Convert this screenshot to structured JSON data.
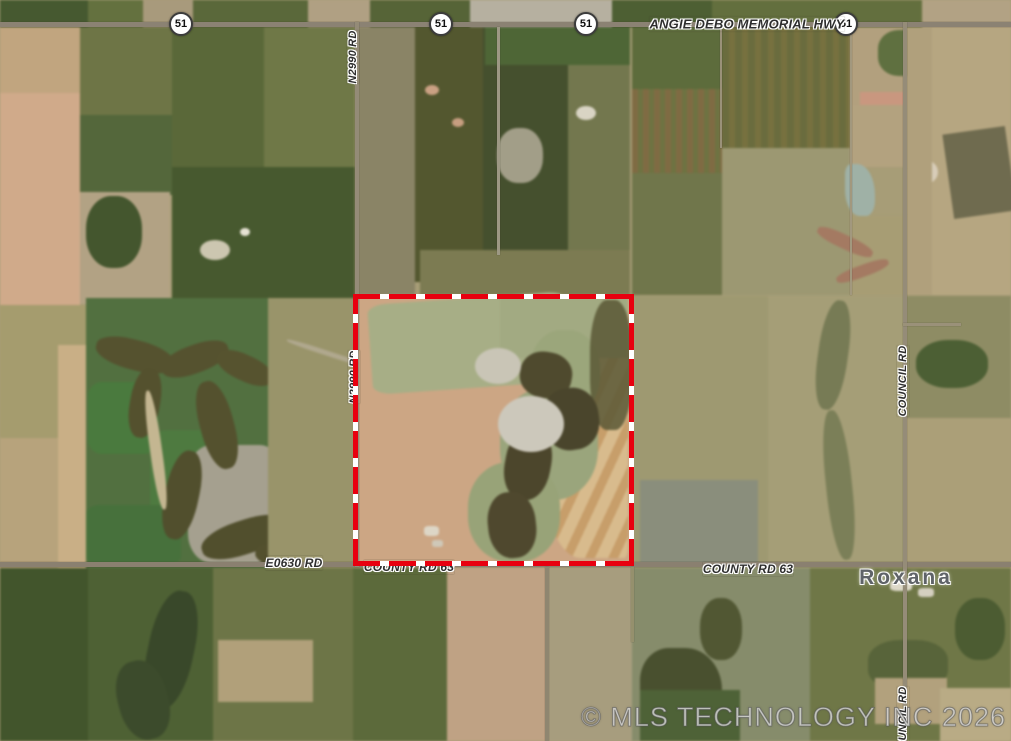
{
  "watermark": {
    "text": "© MLS TECHNOLOGY INC 2026"
  },
  "boundary": {
    "x": 353,
    "y": 294,
    "w": 281,
    "h": 272,
    "t": 5,
    "color": "#e8000f",
    "dash": "#ffffff",
    "seg": 27,
    "gap": 9
  },
  "map": {
    "base_color": "#a79d77",
    "road_color": "#8b8273",
    "shield_label": "51",
    "shields": [
      {
        "x": 181,
        "y": 24
      },
      {
        "x": 441,
        "y": 24
      },
      {
        "x": 586,
        "y": 24
      },
      {
        "x": 846,
        "y": 24
      }
    ],
    "labels": [
      {
        "text": "ANGIE DEBO MEMORIAL HWY",
        "x": 747,
        "y": 24,
        "rot": 0,
        "fs": 13,
        "cls": "road"
      },
      {
        "text": "N2990 RD",
        "x": 353,
        "y": 57,
        "rot": -90,
        "fs": 11,
        "cls": "road"
      },
      {
        "text": "N2990 RD",
        "x": 354,
        "y": 377,
        "rot": -90,
        "fs": 11,
        "cls": "road"
      },
      {
        "text": "COUNCIL RD",
        "x": 903,
        "y": 381,
        "rot": -90,
        "fs": 11,
        "cls": "road"
      },
      {
        "text": "COUNCIL RD",
        "x": 903,
        "y": 722,
        "rot": -90,
        "fs": 11,
        "cls": "road"
      },
      {
        "text": "E0630 RD",
        "x": 294,
        "y": 563,
        "rot": 0,
        "fs": 12,
        "cls": "road"
      },
      {
        "text": "COUNTY RD 63",
        "x": 409,
        "y": 567,
        "rot": 0,
        "fs": 12,
        "cls": "road"
      },
      {
        "text": "COUNTY RD 63",
        "x": 748,
        "y": 569,
        "rot": 0,
        "fs": 12,
        "cls": "road"
      },
      {
        "text": "Roxana",
        "x": 906,
        "y": 578,
        "rot": 0,
        "fs": 21,
        "cls": "place"
      }
    ],
    "roads": [
      {
        "o": "h",
        "x": 0,
        "y": 22,
        "len": 1011,
        "t": 5,
        "c": "#8b8273"
      },
      {
        "o": "h",
        "x": 0,
        "y": 562,
        "len": 1011,
        "t": 5,
        "c": "#8a8070"
      },
      {
        "o": "v",
        "x": 355,
        "y": 22,
        "len": 545,
        "t": 4,
        "c": "#948b77"
      },
      {
        "o": "v",
        "x": 903,
        "y": 22,
        "len": 719,
        "t": 4,
        "c": "#958c78"
      },
      {
        "o": "v",
        "x": 545,
        "y": 567,
        "len": 174,
        "t": 4,
        "c": "#8f8670"
      },
      {
        "o": "v",
        "x": 631,
        "y": 567,
        "len": 75,
        "t": 3,
        "c": "#95906d"
      },
      {
        "o": "v",
        "x": 720,
        "y": 22,
        "len": 126,
        "t": 2,
        "c": "#9a9179"
      },
      {
        "o": "v",
        "x": 850,
        "y": 22,
        "len": 273,
        "t": 2,
        "c": "#a2987e"
      },
      {
        "o": "h",
        "x": 903,
        "y": 323,
        "len": 58,
        "t": 3,
        "c": "#9a9179"
      },
      {
        "o": "v",
        "x": 497,
        "y": 27,
        "len": 228,
        "t": 3,
        "c": "#9d9884"
      }
    ],
    "patches": [
      {
        "x": 0,
        "y": 0,
        "w": 1011,
        "h": 27,
        "c": "#5e6a3e"
      },
      {
        "x": 0,
        "y": 0,
        "w": 88,
        "h": 27,
        "c": "#465930"
      },
      {
        "x": 88,
        "y": 0,
        "w": 55,
        "h": 27,
        "c": "#64713f"
      },
      {
        "x": 143,
        "y": 0,
        "w": 50,
        "h": 27,
        "c": "#a89a7c"
      },
      {
        "x": 193,
        "y": 0,
        "w": 115,
        "h": 27,
        "c": "#5a683a"
      },
      {
        "x": 308,
        "y": 0,
        "w": 62,
        "h": 27,
        "c": "#b0a083"
      },
      {
        "x": 370,
        "y": 0,
        "w": 100,
        "h": 27,
        "c": "#566437"
      },
      {
        "x": 470,
        "y": 0,
        "w": 142,
        "h": 27,
        "c": "#b6b0a0"
      },
      {
        "x": 612,
        "y": 0,
        "w": 100,
        "h": 27,
        "c": "#4d5f33"
      },
      {
        "x": 712,
        "y": 0,
        "w": 210,
        "h": 27,
        "c": "#636f3e"
      },
      {
        "x": 922,
        "y": 0,
        "w": 89,
        "h": 27,
        "c": "#b2a284"
      },
      {
        "x": 0,
        "y": 27,
        "w": 85,
        "h": 70,
        "c": "#c1a57f"
      },
      {
        "x": 0,
        "y": 93,
        "w": 80,
        "h": 212,
        "c": "#d0aa8a"
      },
      {
        "x": 80,
        "y": 27,
        "w": 93,
        "h": 90,
        "c": "#6e7546"
      },
      {
        "x": 80,
        "y": 115,
        "w": 92,
        "h": 80,
        "c": "#54673b"
      },
      {
        "x": 80,
        "y": 192,
        "w": 90,
        "h": 112,
        "c": "#b2a284"
      },
      {
        "x": 86,
        "y": 196,
        "w": 56,
        "h": 72,
        "c": "#44562e",
        "r": "45%"
      },
      {
        "x": 172,
        "y": 27,
        "w": 92,
        "h": 140,
        "c": "#5a6839"
      },
      {
        "x": 264,
        "y": 27,
        "w": 91,
        "h": 140,
        "c": "#6f7847"
      },
      {
        "x": 172,
        "y": 167,
        "w": 183,
        "h": 131,
        "c": "#47592f"
      },
      {
        "x": 200,
        "y": 240,
        "w": 30,
        "h": 20,
        "c": "#ccc6b0",
        "r": "50%"
      },
      {
        "x": 240,
        "y": 228,
        "w": 10,
        "h": 8,
        "c": "#e6e2d4",
        "r": "50%"
      },
      {
        "x": 357,
        "y": 27,
        "w": 58,
        "h": 268,
        "c": "#8a8466"
      },
      {
        "x": 415,
        "y": 27,
        "w": 68,
        "h": 255,
        "c": "#53572f"
      },
      {
        "x": 483,
        "y": 27,
        "w": 85,
        "h": 268,
        "c": "#45502e"
      },
      {
        "x": 568,
        "y": 27,
        "w": 62,
        "h": 268,
        "c": "#73774e"
      },
      {
        "x": 485,
        "y": 27,
        "w": 145,
        "h": 38,
        "c": "#4e6636"
      },
      {
        "x": 420,
        "y": 250,
        "w": 210,
        "h": 45,
        "c": "#7c7b52"
      },
      {
        "x": 425,
        "y": 85,
        "w": 14,
        "h": 10,
        "c": "#caa183",
        "r": "50%"
      },
      {
        "x": 452,
        "y": 118,
        "w": 12,
        "h": 9,
        "c": "#c79e80",
        "r": "50%"
      },
      {
        "x": 576,
        "y": 106,
        "w": 20,
        "h": 14,
        "c": "#d9d4c4",
        "r": "50%"
      },
      {
        "x": 497,
        "y": 128,
        "w": 46,
        "h": 55,
        "c": "#a29e88",
        "r": "45%"
      },
      {
        "x": 632,
        "y": 27,
        "w": 90,
        "h": 62,
        "c": "#5d6c3c"
      },
      {
        "x": 632,
        "y": 89,
        "w": 90,
        "h": 84,
        "c": "#7a6f45",
        "stripes": {
          "a": 90,
          "c1": "#7f6b43",
          "w1": 6,
          "c2": "#6e7342",
          "w2": 5
        }
      },
      {
        "x": 632,
        "y": 173,
        "w": 90,
        "h": 122,
        "c": "#70764b"
      },
      {
        "x": 722,
        "y": 27,
        "w": 128,
        "h": 121,
        "c": "#6d7141",
        "stripes": {
          "a": 90,
          "c1": "#6a6c3e",
          "w1": 7,
          "c2": "#77713f",
          "w2": 6
        }
      },
      {
        "x": 850,
        "y": 27,
        "w": 82,
        "h": 78,
        "c": "#b2a07e"
      },
      {
        "x": 878,
        "y": 30,
        "w": 52,
        "h": 46,
        "c": "#5f7040",
        "r": "40%"
      },
      {
        "x": 860,
        "y": 92,
        "w": 70,
        "h": 72,
        "c": "#c9977f"
      },
      {
        "x": 930,
        "y": 27,
        "w": 81,
        "h": 268,
        "c": "#b6a681"
      },
      {
        "x": 948,
        "y": 130,
        "w": 63,
        "h": 85,
        "c": "#6f6b4f",
        "rot": -8
      },
      {
        "x": 912,
        "y": 160,
        "w": 26,
        "h": 24,
        "c": "#d8cdb9",
        "r": "50%"
      },
      {
        "x": 906,
        "y": 183,
        "w": 26,
        "h": 22,
        "c": "#5c7a44",
        "r": "45%"
      },
      {
        "x": 722,
        "y": 148,
        "w": 128,
        "h": 147,
        "c": "#9c9872"
      },
      {
        "x": 850,
        "y": 105,
        "w": 80,
        "h": 62,
        "c": "#b3a27f"
      },
      {
        "x": 845,
        "y": 164,
        "w": 30,
        "h": 52,
        "c": "#9fb1a6",
        "r": "20% 60% 30% 50%"
      },
      {
        "x": 850,
        "y": 216,
        "w": 80,
        "h": 79,
        "c": "#a79d74"
      },
      {
        "x": 815,
        "y": 235,
        "w": 60,
        "h": 14,
        "c": "#a47a62",
        "rot": 25,
        "r": "40%"
      },
      {
        "x": 835,
        "y": 265,
        "w": 55,
        "h": 12,
        "c": "#a47a62",
        "rot": -20,
        "r": "40%"
      },
      {
        "x": 906,
        "y": 27,
        "w": 26,
        "h": 268,
        "c": "#b0a07c"
      },
      {
        "x": 0,
        "y": 305,
        "w": 86,
        "h": 133,
        "c": "#a59c6e"
      },
      {
        "x": 0,
        "y": 438,
        "w": 86,
        "h": 130,
        "c": "#b7a37c"
      },
      {
        "x": 58,
        "y": 345,
        "w": 28,
        "h": 223,
        "c": "#c9af86"
      },
      {
        "x": 86,
        "y": 298,
        "w": 182,
        "h": 270,
        "c": "#527040"
      },
      {
        "x": 88,
        "y": 382,
        "w": 70,
        "h": 72,
        "c": "#4a7a3e",
        "r": "20%"
      },
      {
        "x": 150,
        "y": 430,
        "w": 85,
        "h": 100,
        "c": "#4e7a40",
        "r": "20%"
      },
      {
        "x": 86,
        "y": 505,
        "w": 95,
        "h": 60,
        "c": "#47713c",
        "r": "15%"
      },
      {
        "x": 188,
        "y": 445,
        "w": 95,
        "h": 118,
        "c": "#a5a08f",
        "r": "25%"
      },
      {
        "x": 95,
        "y": 340,
        "w": 80,
        "h": 30,
        "c": "#55522f",
        "rot": 15,
        "r": "45%"
      },
      {
        "x": 160,
        "y": 345,
        "w": 70,
        "h": 28,
        "c": "#55522f",
        "rot": -20,
        "r": "45%"
      },
      {
        "x": 215,
        "y": 355,
        "w": 60,
        "h": 26,
        "c": "#56532f",
        "rot": 25,
        "r": "45%"
      },
      {
        "x": 130,
        "y": 368,
        "w": 30,
        "h": 70,
        "c": "#54512e",
        "rot": 10,
        "r": "45%"
      },
      {
        "x": 200,
        "y": 380,
        "w": 34,
        "h": 90,
        "c": "#54512e",
        "rot": -15,
        "r": "45%"
      },
      {
        "x": 165,
        "y": 450,
        "w": 34,
        "h": 90,
        "c": "#514f2d",
        "rot": 12,
        "r": "45%"
      },
      {
        "x": 200,
        "y": 520,
        "w": 90,
        "h": 34,
        "c": "#514f2d",
        "rot": -18,
        "r": "45%"
      },
      {
        "x": 255,
        "y": 545,
        "w": 70,
        "h": 26,
        "c": "#53502e",
        "rot": 10,
        "r": "45%"
      },
      {
        "x": 150,
        "y": 390,
        "w": 12,
        "h": 120,
        "c": "#c4b691",
        "rot": -8,
        "r": "45%"
      },
      {
        "x": 268,
        "y": 298,
        "w": 87,
        "h": 270,
        "c": "#99946a"
      },
      {
        "x": 285,
        "y": 350,
        "w": 80,
        "h": 5,
        "c": "#b0a88e",
        "rot": 18,
        "r": "40%"
      },
      {
        "x": 358,
        "y": 296,
        "w": 274,
        "h": 270,
        "c": "#cca684"
      },
      {
        "x": 542,
        "y": 352,
        "w": 86,
        "h": 206,
        "c": "#cdab7c",
        "r": "45% 5% 5% 45%",
        "stripes": {
          "a": 115,
          "c1": "#c79e6a",
          "w1": 9,
          "c2": "#d8bb8d",
          "w2": 12
        }
      },
      {
        "x": 370,
        "y": 298,
        "w": 200,
        "h": 90,
        "c": "#a7ae86",
        "rot": -4,
        "r": "10%"
      },
      {
        "x": 500,
        "y": 298,
        "w": 128,
        "h": 60,
        "c": "#a2aa82"
      },
      {
        "x": 530,
        "y": 330,
        "w": 70,
        "h": 85,
        "c": "#9ba67b",
        "r": "45%"
      },
      {
        "x": 500,
        "y": 388,
        "w": 98,
        "h": 112,
        "c": "#9aa57c",
        "r": "45%"
      },
      {
        "x": 468,
        "y": 462,
        "w": 92,
        "h": 100,
        "c": "#98a378",
        "r": "45%"
      },
      {
        "x": 590,
        "y": 300,
        "w": 42,
        "h": 130,
        "c": "#5b5836",
        "r": "40%",
        "o": 0.85
      },
      {
        "x": 520,
        "y": 352,
        "w": 52,
        "h": 46,
        "c": "#4f4a2e",
        "r": "45%",
        "rot": 10
      },
      {
        "x": 543,
        "y": 388,
        "w": 56,
        "h": 62,
        "c": "#4a452c",
        "r": "45%",
        "rot": -8
      },
      {
        "x": 505,
        "y": 428,
        "w": 46,
        "h": 72,
        "c": "#4c462c",
        "r": "45%",
        "rot": 10
      },
      {
        "x": 488,
        "y": 492,
        "w": 48,
        "h": 66,
        "c": "#4f482e",
        "r": "45%",
        "rot": -6
      },
      {
        "x": 475,
        "y": 348,
        "w": 46,
        "h": 36,
        "c": "#c9c5b6",
        "r": "50%"
      },
      {
        "x": 498,
        "y": 396,
        "w": 66,
        "h": 56,
        "c": "#ccc8bb",
        "r": "50%"
      },
      {
        "x": 424,
        "y": 526,
        "w": 15,
        "h": 10,
        "c": "#ddd6c6",
        "r": "30%"
      },
      {
        "x": 432,
        "y": 540,
        "w": 11,
        "h": 7,
        "c": "#cfc8b8",
        "r": "30%"
      },
      {
        "x": 634,
        "y": 296,
        "w": 270,
        "h": 272,
        "c": "#9e9971"
      },
      {
        "x": 768,
        "y": 296,
        "w": 136,
        "h": 272,
        "c": "#a59e77"
      },
      {
        "x": 640,
        "y": 480,
        "w": 118,
        "h": 86,
        "c": "#8a8e7c"
      },
      {
        "x": 818,
        "y": 300,
        "w": 30,
        "h": 110,
        "c": "#777b55",
        "r": "45%",
        "rot": 8
      },
      {
        "x": 826,
        "y": 410,
        "w": 26,
        "h": 150,
        "c": "#7b7f58",
        "r": "45%",
        "rot": -6
      },
      {
        "x": 906,
        "y": 296,
        "w": 105,
        "h": 122,
        "c": "#8e8c64"
      },
      {
        "x": 916,
        "y": 340,
        "w": 72,
        "h": 48,
        "c": "#4c5f34",
        "r": "45%"
      },
      {
        "x": 906,
        "y": 418,
        "w": 105,
        "h": 150,
        "c": "#ab9f78"
      },
      {
        "x": 0,
        "y": 568,
        "w": 1011,
        "h": 173,
        "c": "#6b7246"
      },
      {
        "x": 0,
        "y": 568,
        "w": 88,
        "h": 173,
        "c": "#42552c"
      },
      {
        "x": 88,
        "y": 568,
        "w": 125,
        "h": 173,
        "c": "#4e6134"
      },
      {
        "x": 148,
        "y": 590,
        "w": 46,
        "h": 120,
        "c": "#39482a",
        "r": "45%",
        "rot": 12
      },
      {
        "x": 118,
        "y": 660,
        "w": 50,
        "h": 80,
        "c": "#3c4b2c",
        "r": "45%",
        "rot": -15
      },
      {
        "x": 213,
        "y": 568,
        "w": 140,
        "h": 173,
        "c": "#6d7547"
      },
      {
        "x": 218,
        "y": 640,
        "w": 95,
        "h": 62,
        "c": "#b1a07a"
      },
      {
        "x": 353,
        "y": 568,
        "w": 94,
        "h": 173,
        "c": "#5c6a3b"
      },
      {
        "x": 447,
        "y": 568,
        "w": 100,
        "h": 173,
        "c": "#bfa284"
      },
      {
        "x": 547,
        "y": 568,
        "w": 85,
        "h": 173,
        "c": "#a79d7e"
      },
      {
        "x": 632,
        "y": 568,
        "w": 178,
        "h": 173,
        "c": "#868c6b"
      },
      {
        "x": 640,
        "y": 648,
        "w": 82,
        "h": 93,
        "c": "#49502f",
        "r": "35% 45% 20% 20%"
      },
      {
        "x": 700,
        "y": 598,
        "w": 42,
        "h": 62,
        "c": "#515733",
        "r": "45%"
      },
      {
        "x": 640,
        "y": 690,
        "w": 100,
        "h": 51,
        "c": "#4e6237"
      },
      {
        "x": 810,
        "y": 568,
        "w": 201,
        "h": 173,
        "c": "#6f7747"
      },
      {
        "x": 868,
        "y": 640,
        "w": 80,
        "h": 50,
        "c": "#58643a",
        "r": "40%"
      },
      {
        "x": 875,
        "y": 678,
        "w": 72,
        "h": 46,
        "c": "#b2a17d"
      },
      {
        "x": 940,
        "y": 688,
        "w": 71,
        "h": 53,
        "c": "#b9ab85"
      },
      {
        "x": 955,
        "y": 598,
        "w": 50,
        "h": 62,
        "c": "#4c5c32",
        "r": "45%"
      },
      {
        "x": 890,
        "y": 580,
        "w": 22,
        "h": 11,
        "c": "#ddd8c8",
        "r": "30%"
      },
      {
        "x": 918,
        "y": 588,
        "w": 16,
        "h": 9,
        "c": "#d5d0c0",
        "r": "30%"
      }
    ]
  }
}
